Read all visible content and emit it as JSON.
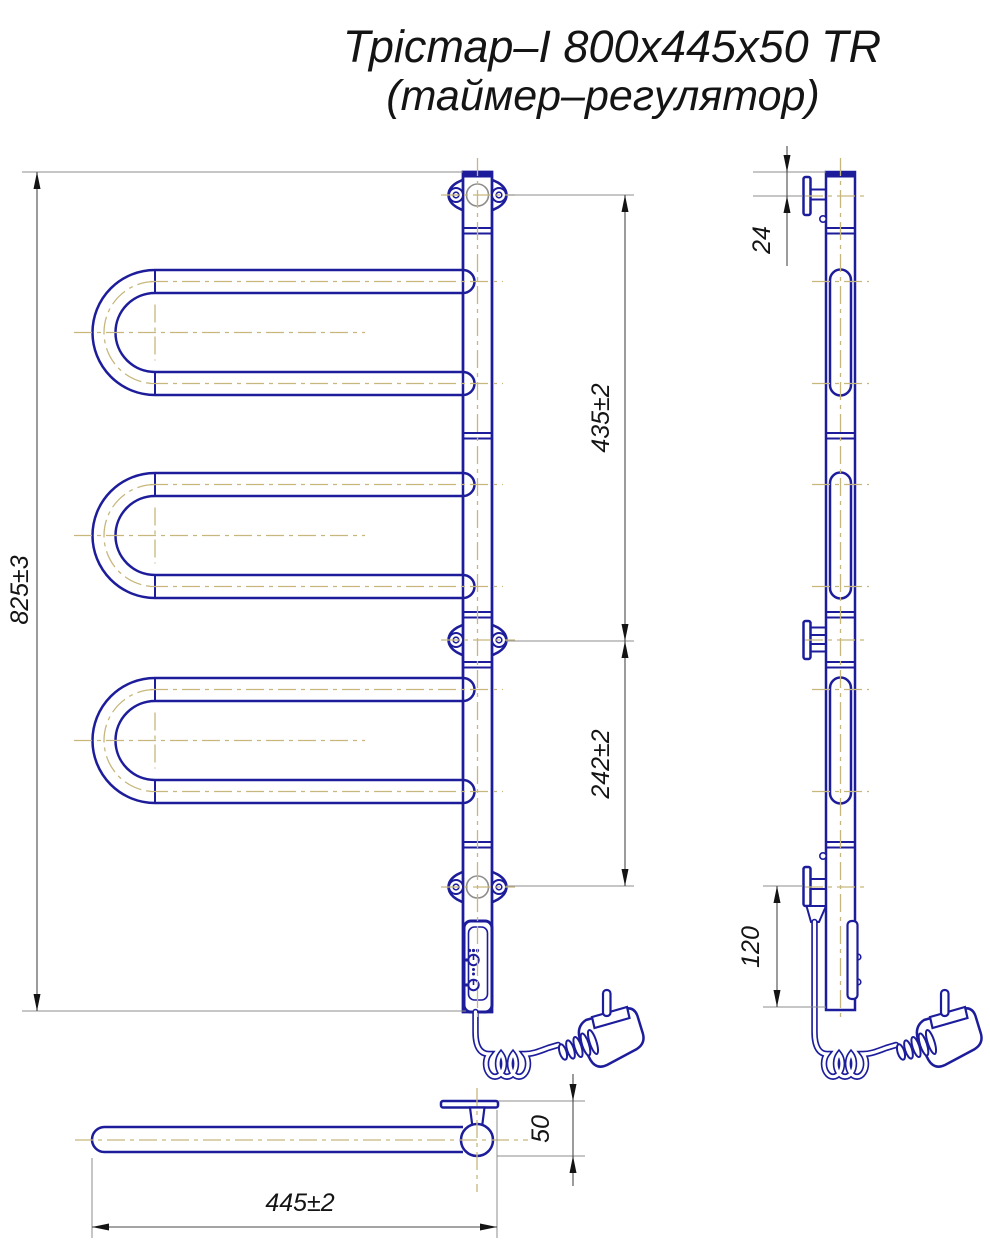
{
  "title": {
    "line1": "Трістар–І 800х445х50 TR",
    "line2": "(таймер–регулятор)"
  },
  "dimensions": {
    "overall_height": "825±3",
    "bracket_spacing_upper": "435±2",
    "bracket_spacing_lower": "242±2",
    "top_bracket_offset": "24",
    "bottom_bracket_offset": "120",
    "depth": "50",
    "overall_width": "445±2"
  },
  "colors": {
    "line_blue": "#1d1d9c",
    "centerline_tan": "#c7b77d",
    "extension_gray": "#8c8c8c",
    "dimension_dark": "#4a4a4a",
    "ink": "#141414",
    "background": "#ffffff"
  }
}
